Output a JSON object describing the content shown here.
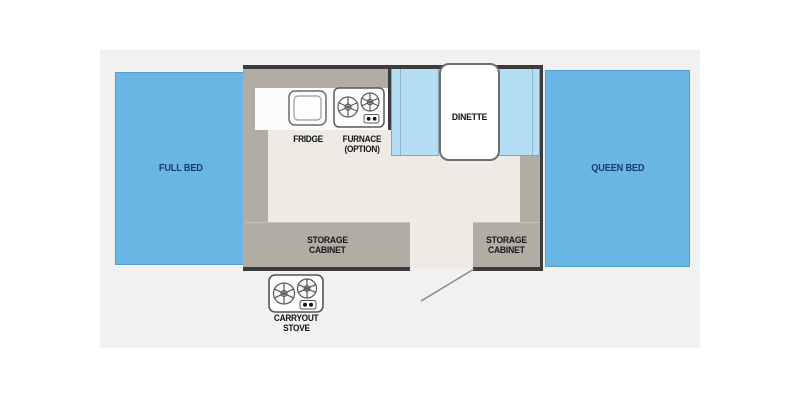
{
  "floorplan": {
    "beds": {
      "full": "FULL BED",
      "queen": "QUEEN BED"
    },
    "dinette": {
      "label": "DINETTE"
    },
    "kitchen": {
      "fridge_label": "FRIDGE",
      "furnace_label_line1": "FURNACE",
      "furnace_label_line2": "(OPTION)"
    },
    "cabinets": {
      "left": {
        "line1": "STORAGE",
        "line2": "CABINET"
      },
      "right": {
        "line1": "STORAGE",
        "line2": "CABINET"
      }
    },
    "carryout_stove": {
      "line1": "CARRYOUT",
      "line2": "STOVE"
    },
    "icons": [
      "fridge-icon",
      "furnace-cooktop-icon",
      "carryout-stove-icon",
      "door-swing-icon"
    ]
  },
  "colors": {
    "canvas-bg": "#f1f1f0",
    "bed-blue": "#69b5e4",
    "bed-edge": "#55a0cf",
    "bed-text": "#15406b",
    "bench-blue": "#b5def4",
    "wall-gray": "#b1ada4",
    "floor-beige": "#edebe4",
    "line-dark": "#3c3c3c"
  }
}
